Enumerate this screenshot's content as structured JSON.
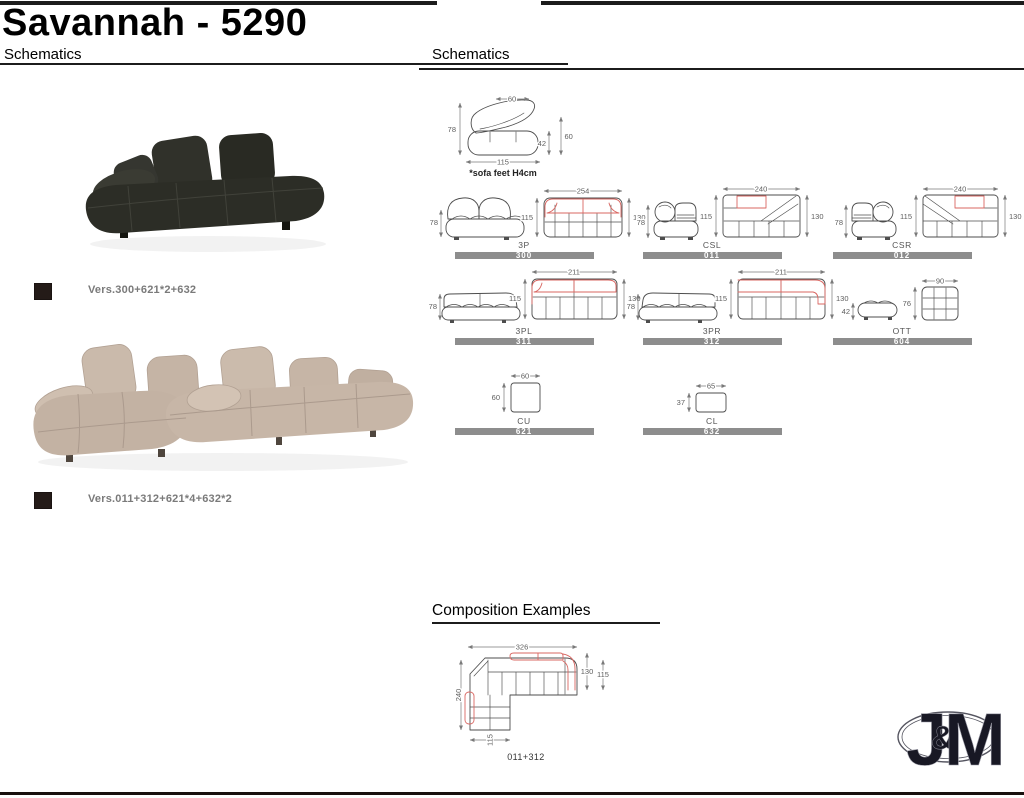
{
  "header": {
    "title": "Savannah - 5290",
    "left_section_title": "Schematics",
    "right_section_title": "Schematics"
  },
  "products": [
    {
      "caption": "Vers.300+621*2+632"
    },
    {
      "caption": "Vers.011+312+621*4+632*2"
    }
  ],
  "schematics": {
    "hero": {
      "width": "60",
      "height": "78",
      "depth": "115",
      "seat_height": "42",
      "back_height": "60",
      "note": "*sofa feet H4cm"
    },
    "modules": [
      {
        "label": "3P",
        "code": "300",
        "width": "254",
        "depth_left": "115",
        "depth_right": "130",
        "side_height": "78"
      },
      {
        "label": "CSL",
        "code": "011",
        "width": "240",
        "depth_left": "115",
        "depth_right": "130",
        "side_height": "78"
      },
      {
        "label": "CSR",
        "code": "012",
        "width": "240",
        "depth_left": "115",
        "depth_right": "130",
        "side_height": "78"
      },
      {
        "label": "3PL",
        "code": "311",
        "width": "211",
        "depth_left": "115",
        "depth_right": "130",
        "side_height": "78"
      },
      {
        "label": "3PR",
        "code": "312",
        "width": "211",
        "depth_left": "115",
        "depth_right": "130",
        "side_height": "78"
      },
      {
        "label": "OTT",
        "code": "604",
        "width": "90",
        "depth_left": "76",
        "side_height": "42"
      },
      {
        "label": "CU",
        "code": "621",
        "width": "60",
        "depth_left": "60"
      },
      {
        "label": "CL",
        "code": "632",
        "width": "65",
        "depth_left": "37"
      }
    ]
  },
  "composition": {
    "section_title": "Composition Examples",
    "caption": "011+312",
    "dims": {
      "width": "326",
      "depth": "240",
      "back": "130",
      "seat": "115",
      "leg": "115"
    }
  },
  "logo": {
    "j": "J",
    "amp": "&",
    "m": "M"
  },
  "colors": {
    "accent_red": "#d96762",
    "bar_gray": "#8d8d8d",
    "line_gray": "#4d4d4d"
  }
}
